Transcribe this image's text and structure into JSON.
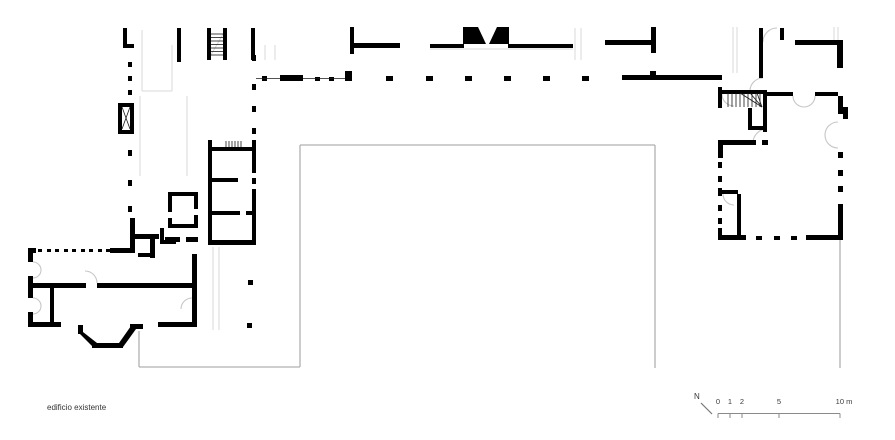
{
  "labels": {
    "existing_building": "edificio existente"
  },
  "north": {
    "label": "N",
    "line": [
      701,
      403,
      712,
      414
    ]
  },
  "scalebar": {
    "y": 413.5,
    "x1": 718,
    "x2": 840,
    "tick_h": 4.5,
    "unit_note": "metres",
    "ticks": [
      {
        "x": 718,
        "label": "0"
      },
      {
        "x": 730,
        "label": "1"
      },
      {
        "x": 742,
        "label": "2"
      },
      {
        "x": 779,
        "label": "5"
      },
      {
        "x": 840,
        "label": "10 m"
      }
    ]
  },
  "colors": {
    "wall": "#000000",
    "thin": "#1a1a1a",
    "courtyard": "#b0b0b0",
    "light": "#d9d9d9",
    "door": "#c6c6c6",
    "scale": "#8a8a8a",
    "text": "#3a3a3a"
  },
  "plan": {
    "walls": [
      [
        123,
        28,
        4,
        18
      ],
      [
        123,
        44,
        11,
        4
      ],
      [
        118,
        103,
        16,
        4
      ],
      [
        118,
        130,
        16,
        4
      ],
      [
        118,
        103,
        4,
        31
      ],
      [
        130,
        103,
        4,
        31
      ],
      [
        177,
        28,
        4,
        34
      ],
      [
        207,
        28,
        4,
        32
      ],
      [
        223,
        28,
        4,
        32
      ],
      [
        251,
        28,
        4,
        32
      ],
      [
        350,
        27,
        4,
        27
      ],
      [
        352,
        43,
        48,
        5
      ],
      [
        430,
        44,
        34,
        4
      ],
      [
        508,
        44,
        65,
        4
      ],
      [
        605,
        40,
        48,
        5
      ],
      [
        651,
        27,
        5,
        26
      ],
      [
        622,
        75,
        100,
        5
      ],
      [
        650,
        71,
        6,
        4
      ],
      [
        280,
        75,
        23,
        6
      ],
      [
        345,
        71,
        7,
        10
      ],
      [
        252,
        140,
        4,
        33
      ],
      [
        252,
        189,
        4,
        56
      ],
      [
        208,
        140,
        4,
        105
      ],
      [
        210,
        147,
        42,
        4
      ],
      [
        208,
        178,
        30,
        4
      ],
      [
        208,
        211,
        32,
        4
      ],
      [
        246,
        211,
        6,
        4
      ],
      [
        208,
        240,
        44,
        5
      ],
      [
        168,
        192,
        30,
        4
      ],
      [
        168,
        192,
        4,
        20
      ],
      [
        168,
        218,
        4,
        10
      ],
      [
        194,
        196,
        4,
        13
      ],
      [
        194,
        215,
        4,
        13
      ],
      [
        168,
        224,
        30,
        4
      ],
      [
        160,
        228,
        4,
        16
      ],
      [
        160,
        240,
        16,
        4
      ],
      [
        133,
        234,
        26,
        5
      ],
      [
        130,
        218,
        5,
        35
      ],
      [
        150,
        237,
        5,
        21
      ],
      [
        138,
        253,
        14,
        4
      ],
      [
        165,
        237,
        15,
        5
      ],
      [
        186,
        237,
        12,
        5
      ],
      [
        192,
        254,
        5,
        73
      ],
      [
        28,
        248,
        8,
        5
      ],
      [
        110,
        248,
        24,
        5
      ],
      [
        28,
        248,
        5,
        14
      ],
      [
        28,
        276,
        5,
        22
      ],
      [
        28,
        312,
        5,
        15
      ],
      [
        33,
        283,
        53,
        5
      ],
      [
        97,
        283,
        97,
        5
      ],
      [
        50,
        288,
        4,
        39
      ],
      [
        29,
        322,
        32,
        5
      ],
      [
        78,
        325,
        5,
        9
      ],
      [
        92,
        343,
        31,
        5
      ],
      [
        130,
        324,
        13,
        5
      ],
      [
        158,
        322,
        39,
        5
      ],
      [
        759,
        28,
        4,
        50
      ],
      [
        780,
        28,
        4,
        12
      ],
      [
        795,
        40,
        46,
        5
      ],
      [
        837,
        40,
        6,
        28
      ],
      [
        718,
        87,
        4,
        21
      ],
      [
        722,
        90,
        45,
        4
      ],
      [
        763,
        92,
        4,
        40
      ],
      [
        748,
        108,
        4,
        20
      ],
      [
        748,
        126,
        19,
        4
      ],
      [
        767,
        92,
        26,
        4
      ],
      [
        815,
        92,
        23,
        4
      ],
      [
        838,
        96,
        5,
        18
      ],
      [
        843,
        107,
        5,
        12
      ],
      [
        718,
        140,
        5,
        18
      ],
      [
        720,
        140,
        36,
        5
      ],
      [
        762,
        140,
        6,
        5
      ],
      [
        838,
        204,
        5,
        36
      ],
      [
        718,
        188,
        4,
        8
      ],
      [
        718,
        190,
        20,
        4
      ],
      [
        737,
        194,
        4,
        45
      ],
      [
        718,
        228,
        4,
        12
      ],
      [
        718,
        235,
        28,
        5
      ],
      [
        806,
        235,
        37,
        5
      ]
    ],
    "dots": [
      [
        128,
        62,
        4,
        5
      ],
      [
        128,
        76,
        4,
        5
      ],
      [
        128,
        90,
        4,
        5
      ],
      [
        128,
        150,
        4,
        6
      ],
      [
        128,
        180,
        4,
        6
      ],
      [
        128,
        206,
        4,
        6
      ],
      [
        252,
        55,
        4,
        6
      ],
      [
        252,
        84,
        4,
        6
      ],
      [
        252,
        106,
        4,
        6
      ],
      [
        252,
        128,
        4,
        6
      ],
      [
        252,
        178,
        4,
        6
      ],
      [
        248,
        280,
        5,
        5
      ],
      [
        247,
        323,
        5,
        5
      ],
      [
        262,
        76,
        5,
        5
      ],
      [
        315,
        77,
        5,
        4
      ],
      [
        329,
        77,
        5,
        4
      ],
      [
        386,
        76,
        7,
        5
      ],
      [
        426,
        76,
        7,
        5
      ],
      [
        465,
        76,
        7,
        5
      ],
      [
        504,
        76,
        7,
        5
      ],
      [
        543,
        76,
        7,
        5
      ],
      [
        582,
        76,
        7,
        5
      ],
      [
        38,
        249,
        4,
        3
      ],
      [
        47,
        249,
        4,
        3
      ],
      [
        55,
        249,
        4,
        3
      ],
      [
        64,
        249,
        4,
        3
      ],
      [
        72,
        249,
        4,
        3
      ],
      [
        81,
        249,
        4,
        3
      ],
      [
        89,
        249,
        4,
        3
      ],
      [
        98,
        249,
        4,
        3
      ],
      [
        106,
        249,
        4,
        3
      ],
      [
        163,
        240,
        5,
        4
      ],
      [
        718,
        162,
        4,
        6
      ],
      [
        718,
        176,
        4,
        6
      ],
      [
        718,
        205,
        4,
        6
      ],
      [
        718,
        218,
        4,
        6
      ],
      [
        838,
        152,
        5,
        6
      ],
      [
        838,
        170,
        5,
        6
      ],
      [
        838,
        186,
        5,
        6
      ],
      [
        756,
        236,
        6,
        4
      ],
      [
        774,
        236,
        6,
        4
      ],
      [
        791,
        236,
        6,
        4
      ]
    ],
    "polys": [
      [
        [
          463,
          27
        ],
        [
          478,
          27
        ],
        [
          486,
          44
        ],
        [
          463,
          44
        ]
      ],
      [
        [
          497,
          27
        ],
        [
          509,
          27
        ],
        [
          509,
          44
        ],
        [
          489,
          44
        ]
      ],
      [
        [
          78,
          332
        ],
        [
          83,
          332
        ],
        [
          97,
          343
        ],
        [
          93,
          347
        ]
      ],
      [
        [
          119,
          343
        ],
        [
          123,
          347
        ],
        [
          136,
          329
        ],
        [
          131,
          326
        ]
      ]
    ],
    "courtyard_lines": [
      [
        300,
        145,
        655,
        145
      ],
      [
        300,
        145,
        300,
        367
      ],
      [
        655,
        145,
        655,
        368
      ],
      [
        139,
        367,
        300,
        367
      ],
      [
        139,
        331,
        139,
        367
      ],
      [
        840,
        240,
        840,
        368
      ]
    ],
    "light_lines": [
      [
        142,
        30,
        142,
        91
      ],
      [
        172,
        45,
        172,
        91
      ],
      [
        142,
        91,
        172,
        91
      ],
      [
        140,
        96,
        140,
        176
      ],
      [
        187,
        96,
        187,
        176
      ],
      [
        213,
        247,
        213,
        330
      ],
      [
        219,
        247,
        219,
        330
      ],
      [
        733,
        27,
        733,
        73
      ],
      [
        737,
        27,
        737,
        73
      ],
      [
        834,
        27,
        834,
        40
      ],
      [
        838,
        27,
        838,
        40
      ],
      [
        575,
        28,
        575,
        60
      ],
      [
        581,
        28,
        581,
        60
      ],
      [
        265,
        45,
        265,
        60
      ],
      [
        275,
        45,
        275,
        60
      ],
      [
        430,
        49,
        573,
        49
      ],
      [
        211,
        55,
        223,
        34
      ]
    ],
    "thin_lines": [
      [
        256,
        78.5,
        280,
        78.5
      ],
      [
        303,
        78.5,
        345,
        78.5
      ],
      [
        122,
        107,
        130,
        129
      ],
      [
        130,
        107,
        122,
        129
      ],
      [
        211,
        34,
        223,
        34
      ],
      [
        211,
        37.5,
        223,
        37.5
      ],
      [
        211,
        41,
        223,
        41
      ],
      [
        211,
        44.5,
        223,
        44.5
      ],
      [
        211,
        48,
        223,
        48
      ],
      [
        211,
        51.5,
        223,
        51.5
      ],
      [
        211,
        55,
        223,
        55
      ],
      [
        226,
        141,
        226,
        147
      ],
      [
        229,
        141,
        229,
        147
      ],
      [
        232,
        141,
        232,
        147
      ],
      [
        235,
        141,
        235,
        147
      ],
      [
        238,
        141,
        238,
        147
      ],
      [
        241,
        141,
        241,
        147
      ],
      [
        728,
        93,
        728,
        107
      ],
      [
        732,
        93,
        732,
        107
      ],
      [
        736,
        93,
        736,
        107
      ],
      [
        740,
        93,
        740,
        107
      ],
      [
        744,
        93,
        744,
        107
      ],
      [
        748,
        93,
        748,
        107
      ],
      [
        752,
        93,
        752,
        107
      ],
      [
        756,
        93,
        756,
        107
      ],
      [
        760,
        93,
        760,
        107
      ],
      [
        762,
        107,
        740,
        93
      ],
      [
        762,
        107,
        750,
        93
      ],
      [
        762,
        107,
        757,
        93
      ]
    ],
    "door_arcs": [
      "M33,262 A8,8 0 0 1 41,270",
      "M33,278 A8,8 0 0 0 41,270",
      "M33,298 A8,8 0 0 1 41,306",
      "M33,314 A8,8 0 0 0 41,306",
      "M97,283 A12,12 0 0 0 85,271",
      "M192,298 A11,11 0 0 0 181,309",
      "M763,42 A14,14 0 0 1 777,28",
      "M722,94 A12,12 0 0 0 734,106",
      "M763,78 A13,13 0 0 0 750,91",
      "M767,129 A14,14 0 0 0 753,143",
      "M793,96 A11,11 0 0 0 804,107",
      "M815,96 A11,11 0 0 1 804,107",
      "M838,122 A13,13 0 0 0 825,135",
      "M838,148 A13,13 0 0 1 825,135",
      "M723,194 A11,11 0 0 0 734,205"
    ]
  }
}
